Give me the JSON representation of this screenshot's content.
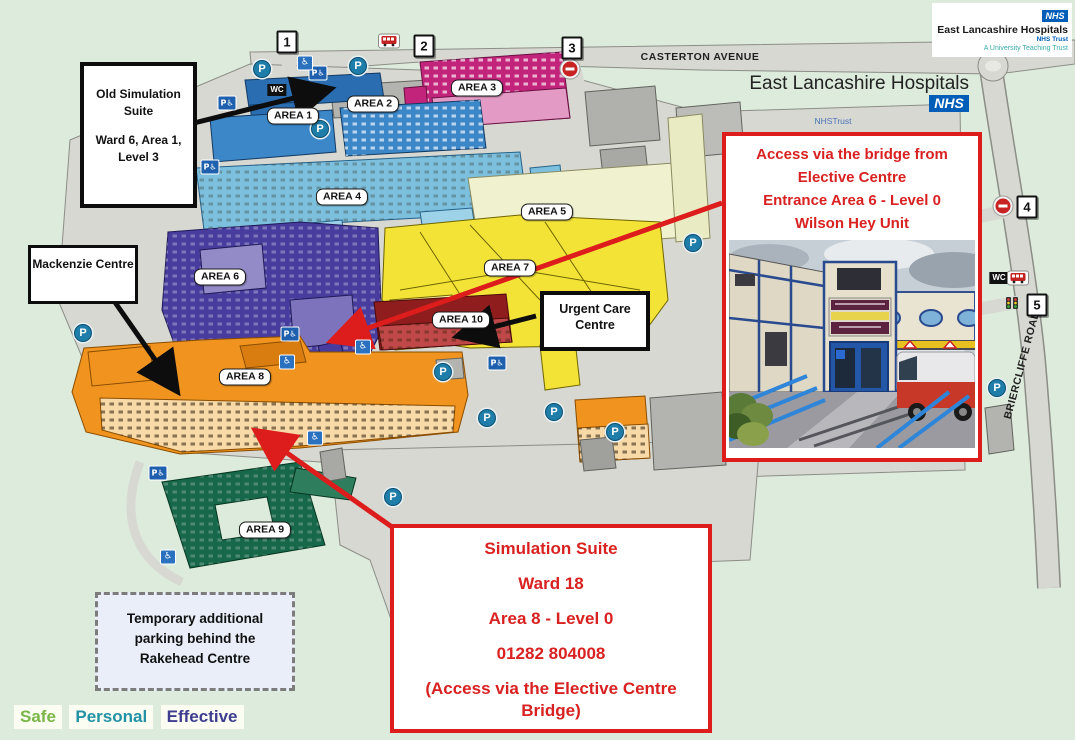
{
  "brand": {
    "corner": {
      "nhs": "NHS",
      "org": "East Lancashire Hospitals",
      "trust": "NHS Trust",
      "tagline": "A University Teaching Trust"
    },
    "header": {
      "org": "East Lancashire Hospitals",
      "nhs": "NHS",
      "trust": "NHSTrust",
      "hospital": "Burnley General Hospital"
    },
    "nhs_blue": "#005eb8"
  },
  "callouts": {
    "old_sim": {
      "title": "Old Simulation Suite",
      "detail": "Ward 6, Area 1, Level 3"
    },
    "mackenzie": {
      "label": "Mackenzie Centre"
    },
    "urgent": {
      "label": "Urgent Care Centre"
    },
    "access": {
      "line1": "Access via the bridge from",
      "line2": "Elective Centre",
      "line3": "Entrance Area 6 - Level 0",
      "line4": "Wilson Hey Unit"
    },
    "sim": {
      "line1": "Simulation Suite",
      "line2": "Ward 18",
      "line3": "Area 8 - Level 0",
      "line4": "01282 804008",
      "line5": "(Access via the Elective Centre Bridge)"
    },
    "parking_note": {
      "text": "Temporary additional parking behind the Rakehead Centre"
    },
    "accent_red": "#dd1c1c"
  },
  "map": {
    "areas": [
      "AREA 1",
      "AREA 2",
      "AREA 3",
      "AREA 4",
      "AREA 5",
      "AREA 6",
      "AREA 7",
      "AREA 8",
      "AREA 9",
      "AREA 10"
    ],
    "markers": [
      "1",
      "2",
      "3",
      "4",
      "5"
    ],
    "roads": {
      "top": "CASTERTON AVENUE",
      "right": "BRIERCLIFFE ROAD"
    },
    "icons": {
      "parking": "P",
      "accessible_parking": "P♿",
      "accessible": "♿",
      "wc": "WC"
    },
    "area_colors": {
      "areas_1_2_4_blue": "#3b87c8",
      "area3_magenta": "#c2247c",
      "area5_pale": "#f0f2cf",
      "area6_purple": "#483d9e",
      "area7_yellow": "#f4e337",
      "area8_orange": "#f0941f",
      "area9_green": "#17684b",
      "area10_red": "#9e1f1f"
    }
  },
  "footer": {
    "items": [
      {
        "label": "Safe",
        "color": "#7ab648"
      },
      {
        "label": "Personal",
        "color": "#2292a4"
      },
      {
        "label": "Effective",
        "color": "#3f3d8f"
      }
    ]
  }
}
